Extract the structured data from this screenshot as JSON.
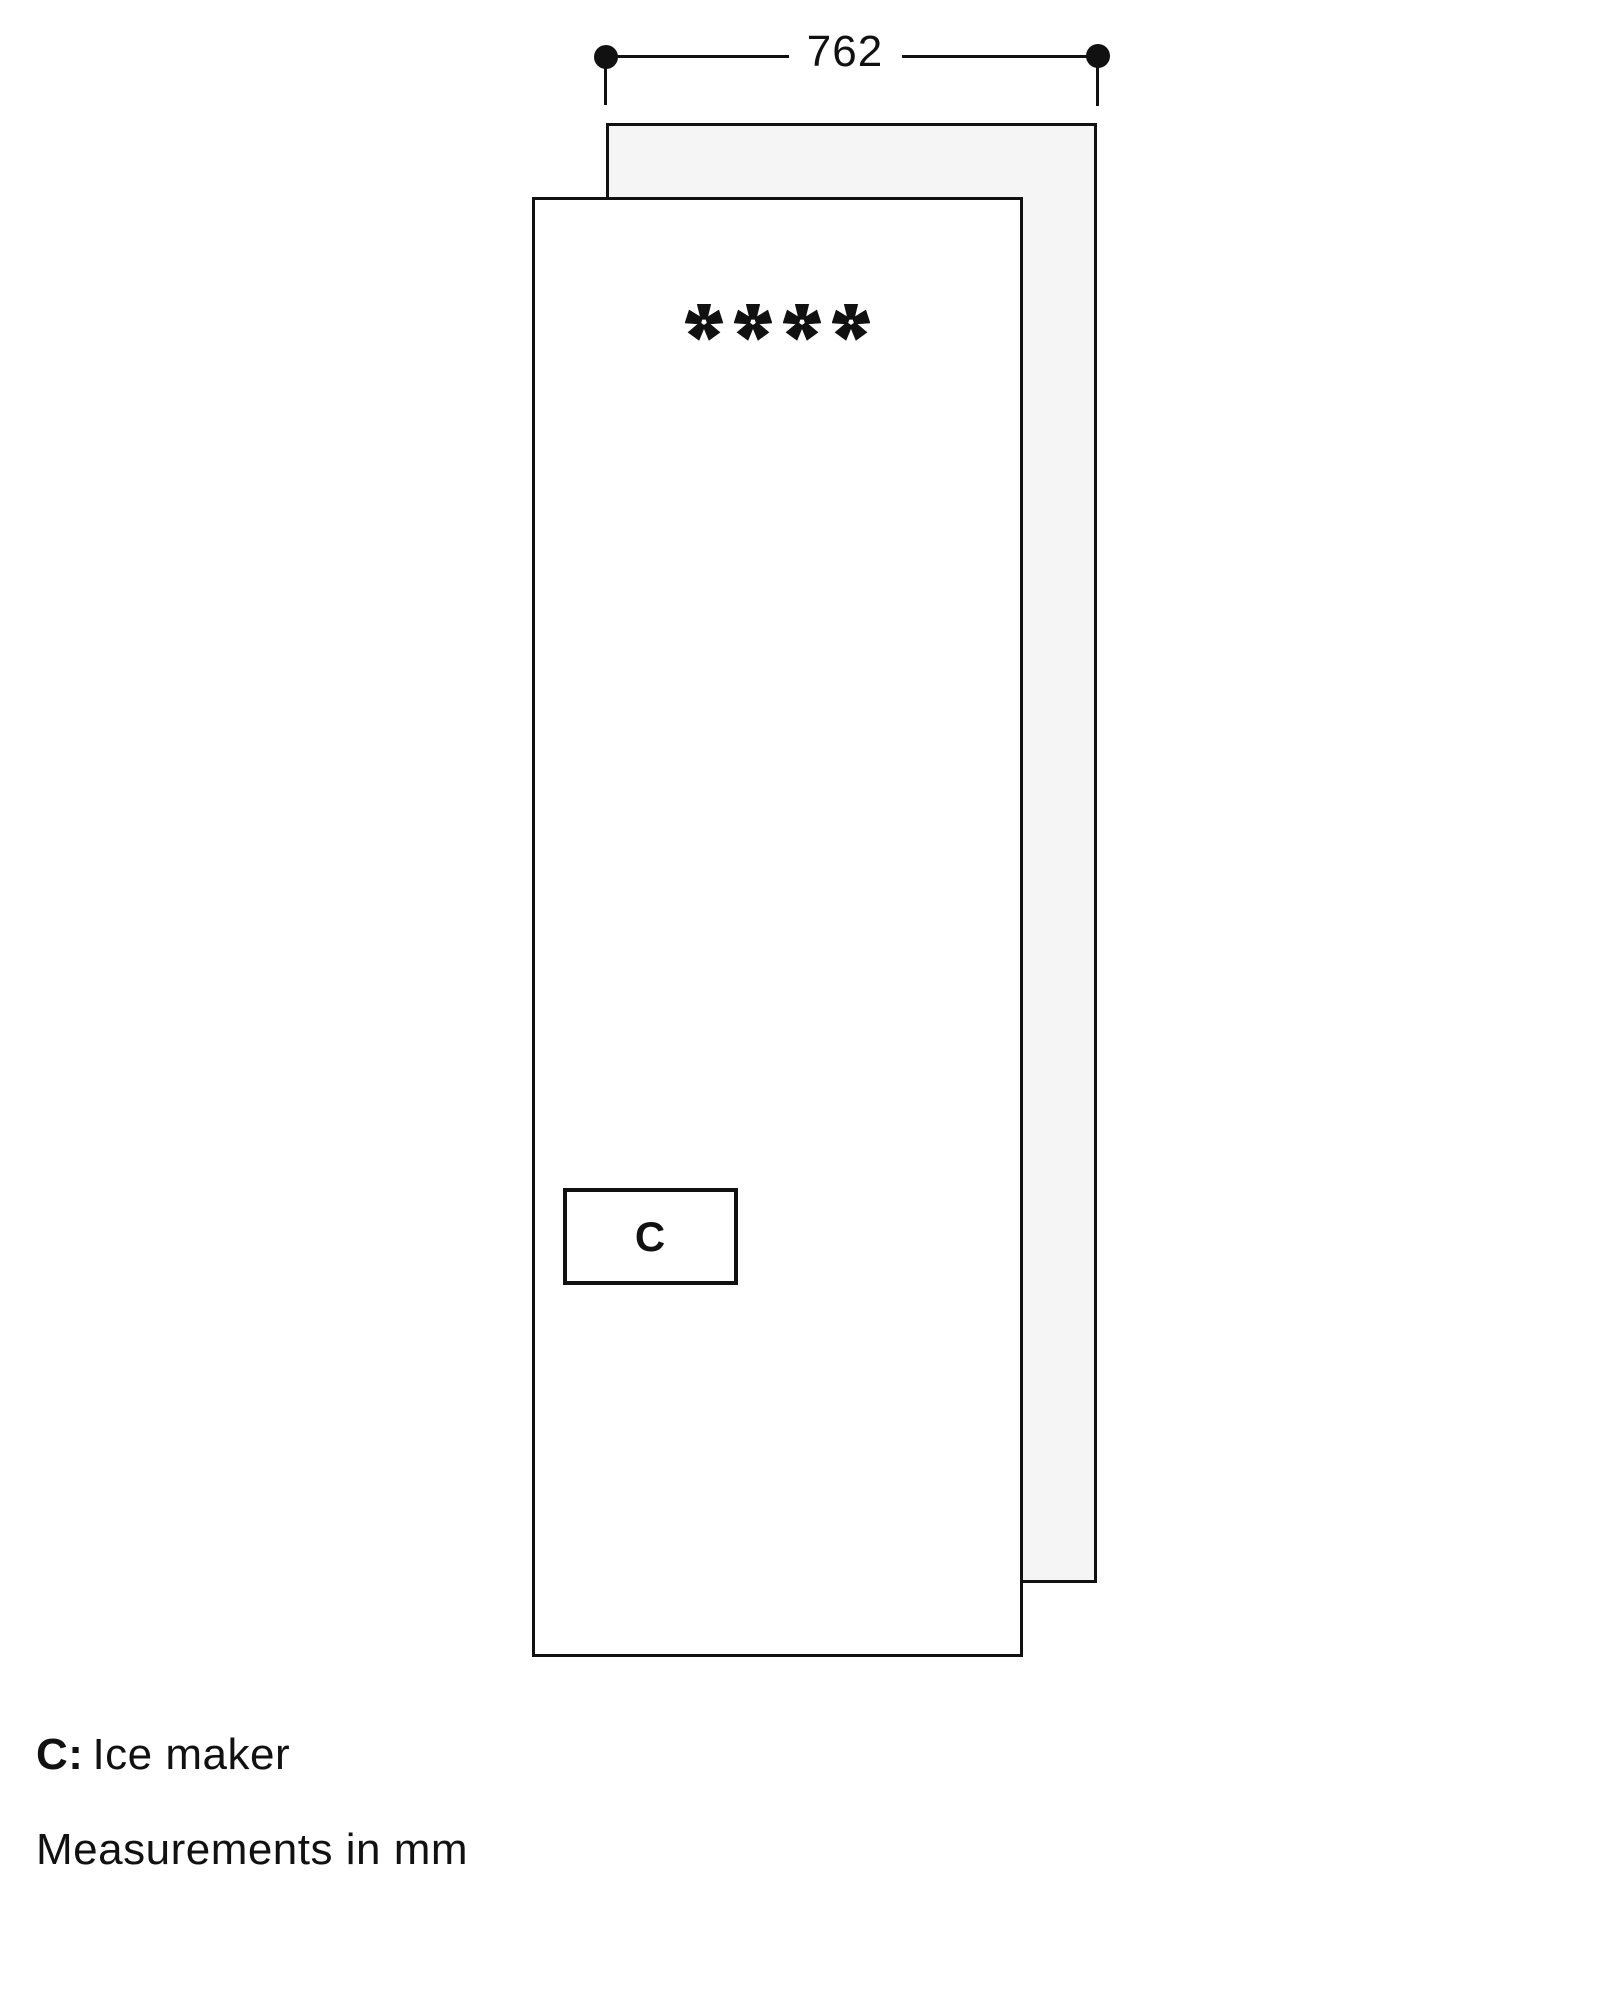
{
  "dimension": {
    "width_label": "762"
  },
  "appliance": {
    "star_rating": 4,
    "star_symbols": "****",
    "ice_maker_box_label": "C"
  },
  "legend": [
    {
      "key": "C:",
      "label": "Ice maker"
    }
  ],
  "note": "Measurements in mm",
  "colors": {
    "line": "#111111",
    "back_panel_fill": "#f5f5f6",
    "front_panel_fill": "#ffffff"
  }
}
